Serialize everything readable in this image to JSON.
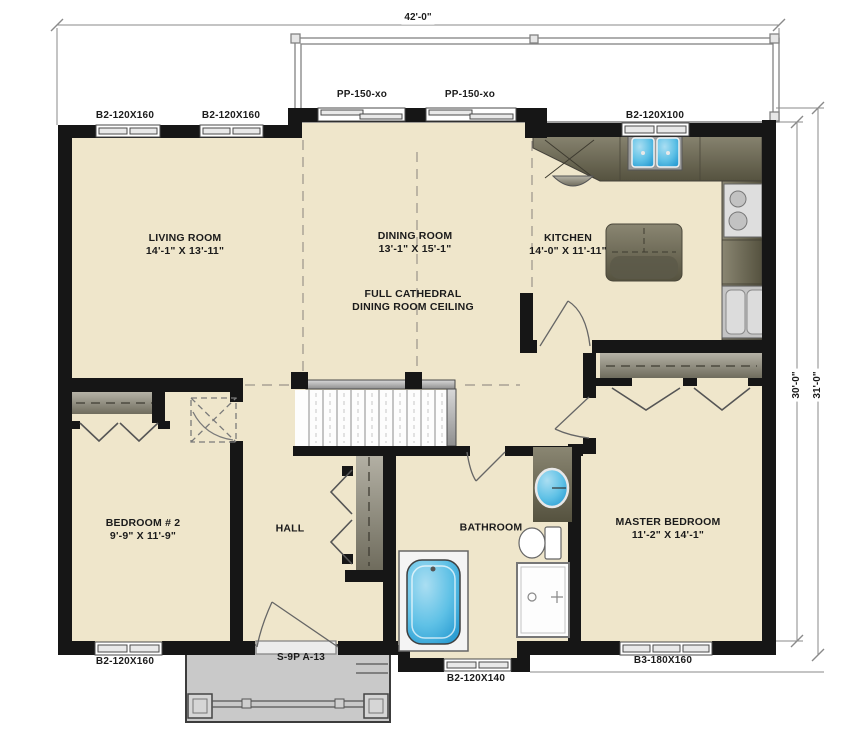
{
  "plan": {
    "title": "bungalow-floor-plan",
    "dims": {
      "top_width": "42'-0\"",
      "right_inner_depth": "30'-0\"",
      "right_outer_depth": "31'-0\""
    },
    "rooms": [
      {
        "id": "living",
        "name": "LIVING ROOM",
        "size": "14'-1\" X 13'-11\""
      },
      {
        "id": "dining",
        "name": "DINING ROOM",
        "size": "13'-1\" X 15'-1\""
      },
      {
        "id": "kitchen",
        "name": "KITCHEN",
        "size": "14'-0\" X 11'-11\""
      },
      {
        "id": "bedroom2",
        "name": "BEDROOM # 2",
        "size": "9'-9\" X 11'-9\""
      },
      {
        "id": "hall",
        "name": "HALL",
        "size": ""
      },
      {
        "id": "bathroom",
        "name": "BATHROOM",
        "size": ""
      },
      {
        "id": "master",
        "name": "MASTER BEDROOM",
        "size": "11'-2\" X 14'-1\""
      }
    ],
    "note": {
      "line1": "FULL CATHEDRAL",
      "line2": "DINING ROOM CEILING"
    },
    "openings": {
      "top_win_1": "B2-120X160",
      "top_win_2": "B2-120X160",
      "patio_door_1": "PP-150-xo",
      "patio_door_2": "PP-150-xo",
      "kitchen_win": "B2-120X100",
      "bed2_win": "B2-120X160",
      "front_door": "S-9P A-13",
      "bath_win": "B2-120X140",
      "master_win": "B3-180X160"
    },
    "fixtures": [
      "kitchen-sink",
      "cooktop",
      "refrigerator",
      "kitchen-island",
      "staircase",
      "bathtub",
      "shower",
      "toilet",
      "vanity-sink",
      "closet-shelves",
      "front-porch",
      "rear-deck"
    ],
    "colors": {
      "floor": "#efe6cb",
      "wall": "#161616",
      "counter": "#6e6a57",
      "fixture_blue": "#5fc1e6",
      "porch": "#c9c9c9",
      "linework": "#8a8a8a"
    }
  }
}
